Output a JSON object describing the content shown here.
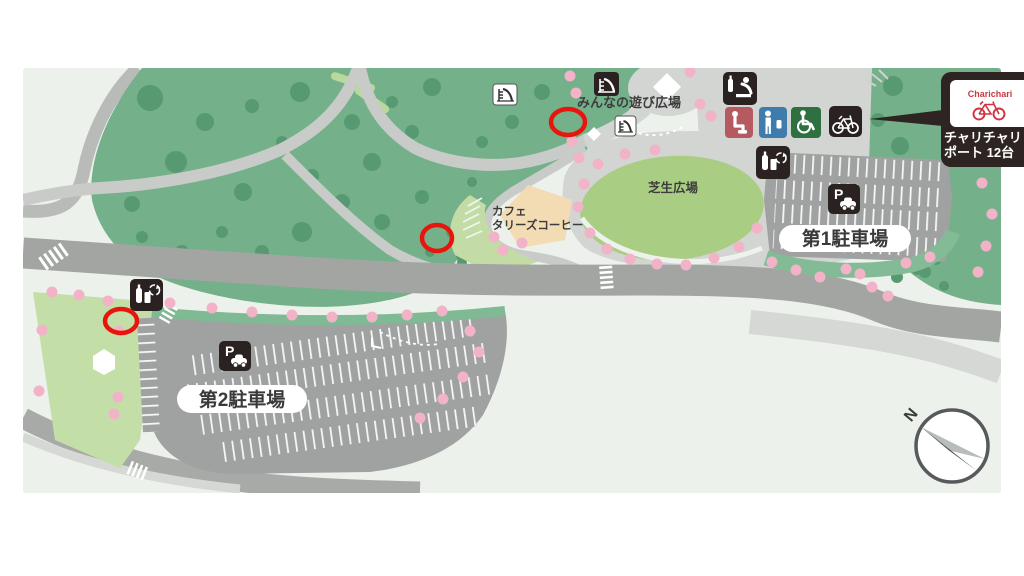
{
  "page": {
    "bg": "#ffffff"
  },
  "map": {
    "bg": "#ecf2eb",
    "labels": {
      "play_plaza": "みんなの遊び広場",
      "lawn_plaza": "芝生広場",
      "cafe_line1": "カフェ",
      "cafe_line2": "タリーズコーヒー",
      "parking1": "第1駐車場",
      "parking2": "第2駐車場",
      "compass_north": "N"
    },
    "callout": {
      "brand": "Charichari",
      "line1": "チャリチャリ",
      "line2": "ポート 12台",
      "brand_color": "#cf3540"
    },
    "icons": {
      "slide": "playground-slide",
      "baby_care": "diaper-changing-station",
      "toilet_women": "seated-figure-toilet",
      "toilet_men": "standing-figure-toilet",
      "toilet_accessible": "wheelchair",
      "bicycle_parking": "bicycle",
      "vending_recycle": "bottle-can-recycle",
      "parking": "P-with-car",
      "compass": "north-needle",
      "charichari_bike": "red-bicycle"
    },
    "colors": {
      "forest": "#74b089",
      "tree": "#579a72",
      "lawn": "#aacd84",
      "light_green": "#c3dca6",
      "road": "#a3a5a3",
      "path": "#c9cbc9",
      "plaza": "#d2d5d2",
      "parking": "#9fa2a0",
      "cherry": "#f2b3c9",
      "cafe": "#f3dcb3",
      "icon_dark": "#2a2220",
      "toilet_women": "#b55a60",
      "toilet_men": "#3f7cae",
      "toilet_accessible": "#2f7040",
      "marker_red": "#e8150d"
    },
    "markers": [
      {
        "x": 568,
        "y": 122,
        "rx": 17,
        "ry": 13
      },
      {
        "x": 437,
        "y": 238,
        "rx": 15,
        "ry": 13
      },
      {
        "x": 121,
        "y": 321,
        "rx": 16,
        "ry": 12
      }
    ],
    "trees": [
      [
        150,
        98,
        13
      ],
      [
        205,
        122,
        9
      ],
      [
        176,
        162,
        11
      ],
      [
        132,
        204,
        8
      ],
      [
        252,
        106,
        7
      ],
      [
        300,
        92,
        10
      ],
      [
        282,
        142,
        6
      ],
      [
        243,
        192,
        9
      ],
      [
        312,
        176,
        7
      ],
      [
        352,
        122,
        8
      ],
      [
        392,
        102,
        6
      ],
      [
        432,
        87,
        9
      ],
      [
        412,
        132,
        7
      ],
      [
        372,
        162,
        9
      ],
      [
        342,
        202,
        8
      ],
      [
        302,
        232,
        10
      ],
      [
        262,
        252,
        7
      ],
      [
        222,
        232,
        6
      ],
      [
        382,
        222,
        8
      ],
      [
        422,
        197,
        7
      ],
      [
        452,
        232,
        6
      ],
      [
        472,
        182,
        5
      ],
      [
        182,
        252,
        7
      ],
      [
        142,
        237,
        6
      ],
      [
        482,
        142,
        6
      ],
      [
        512,
        122,
        7
      ],
      [
        542,
        92,
        8
      ],
      [
        462,
        262,
        5
      ],
      [
        430,
        252,
        5
      ],
      [
        893,
        86,
        10
      ],
      [
        878,
        120,
        7
      ],
      [
        900,
        146,
        9
      ],
      [
        882,
        168,
        6
      ],
      [
        902,
        192,
        7
      ],
      [
        888,
        218,
        6
      ],
      [
        905,
        246,
        6
      ],
      [
        925,
        272,
        6
      ],
      [
        944,
        286,
        5
      ],
      [
        746,
        202,
        6
      ],
      [
        897,
        277,
        6
      ],
      [
        917,
        270,
        5
      ],
      [
        936,
        260,
        5
      ],
      [
        478,
        248,
        6
      ],
      [
        496,
        263,
        5
      ],
      [
        460,
        256,
        4
      ]
    ],
    "cherry_dots": [
      [
        570,
        76
      ],
      [
        576,
        93
      ],
      [
        572,
        141
      ],
      [
        579,
        158
      ],
      [
        700,
        104
      ],
      [
        711,
        116
      ],
      [
        734,
        112
      ],
      [
        747,
        127
      ],
      [
        690,
        72
      ],
      [
        598,
        164
      ],
      [
        584,
        184
      ],
      [
        578,
        207
      ],
      [
        590,
        233
      ],
      [
        607,
        249
      ],
      [
        630,
        259
      ],
      [
        657,
        264
      ],
      [
        686,
        265
      ],
      [
        714,
        258
      ],
      [
        739,
        247
      ],
      [
        757,
        228
      ],
      [
        625,
        154
      ],
      [
        655,
        150
      ],
      [
        987,
        148
      ],
      [
        982,
        183
      ],
      [
        992,
        214
      ],
      [
        986,
        246
      ],
      [
        978,
        272
      ],
      [
        772,
        262
      ],
      [
        796,
        270
      ],
      [
        820,
        277
      ],
      [
        846,
        269
      ],
      [
        860,
        274
      ],
      [
        872,
        287
      ],
      [
        888,
        296
      ],
      [
        906,
        263
      ],
      [
        930,
        257
      ],
      [
        170,
        303
      ],
      [
        212,
        308
      ],
      [
        252,
        312
      ],
      [
        292,
        315
      ],
      [
        332,
        317
      ],
      [
        372,
        317
      ],
      [
        407,
        315
      ],
      [
        442,
        311
      ],
      [
        470,
        331
      ],
      [
        479,
        352
      ],
      [
        463,
        377
      ],
      [
        443,
        399
      ],
      [
        420,
        418
      ],
      [
        52,
        292
      ],
      [
        79,
        295
      ],
      [
        108,
        301
      ],
      [
        42,
        330
      ],
      [
        119,
        331
      ],
      [
        39,
        391
      ],
      [
        118,
        397
      ],
      [
        114,
        414
      ],
      [
        494,
        237
      ],
      [
        503,
        250
      ],
      [
        522,
        243
      ]
    ]
  }
}
